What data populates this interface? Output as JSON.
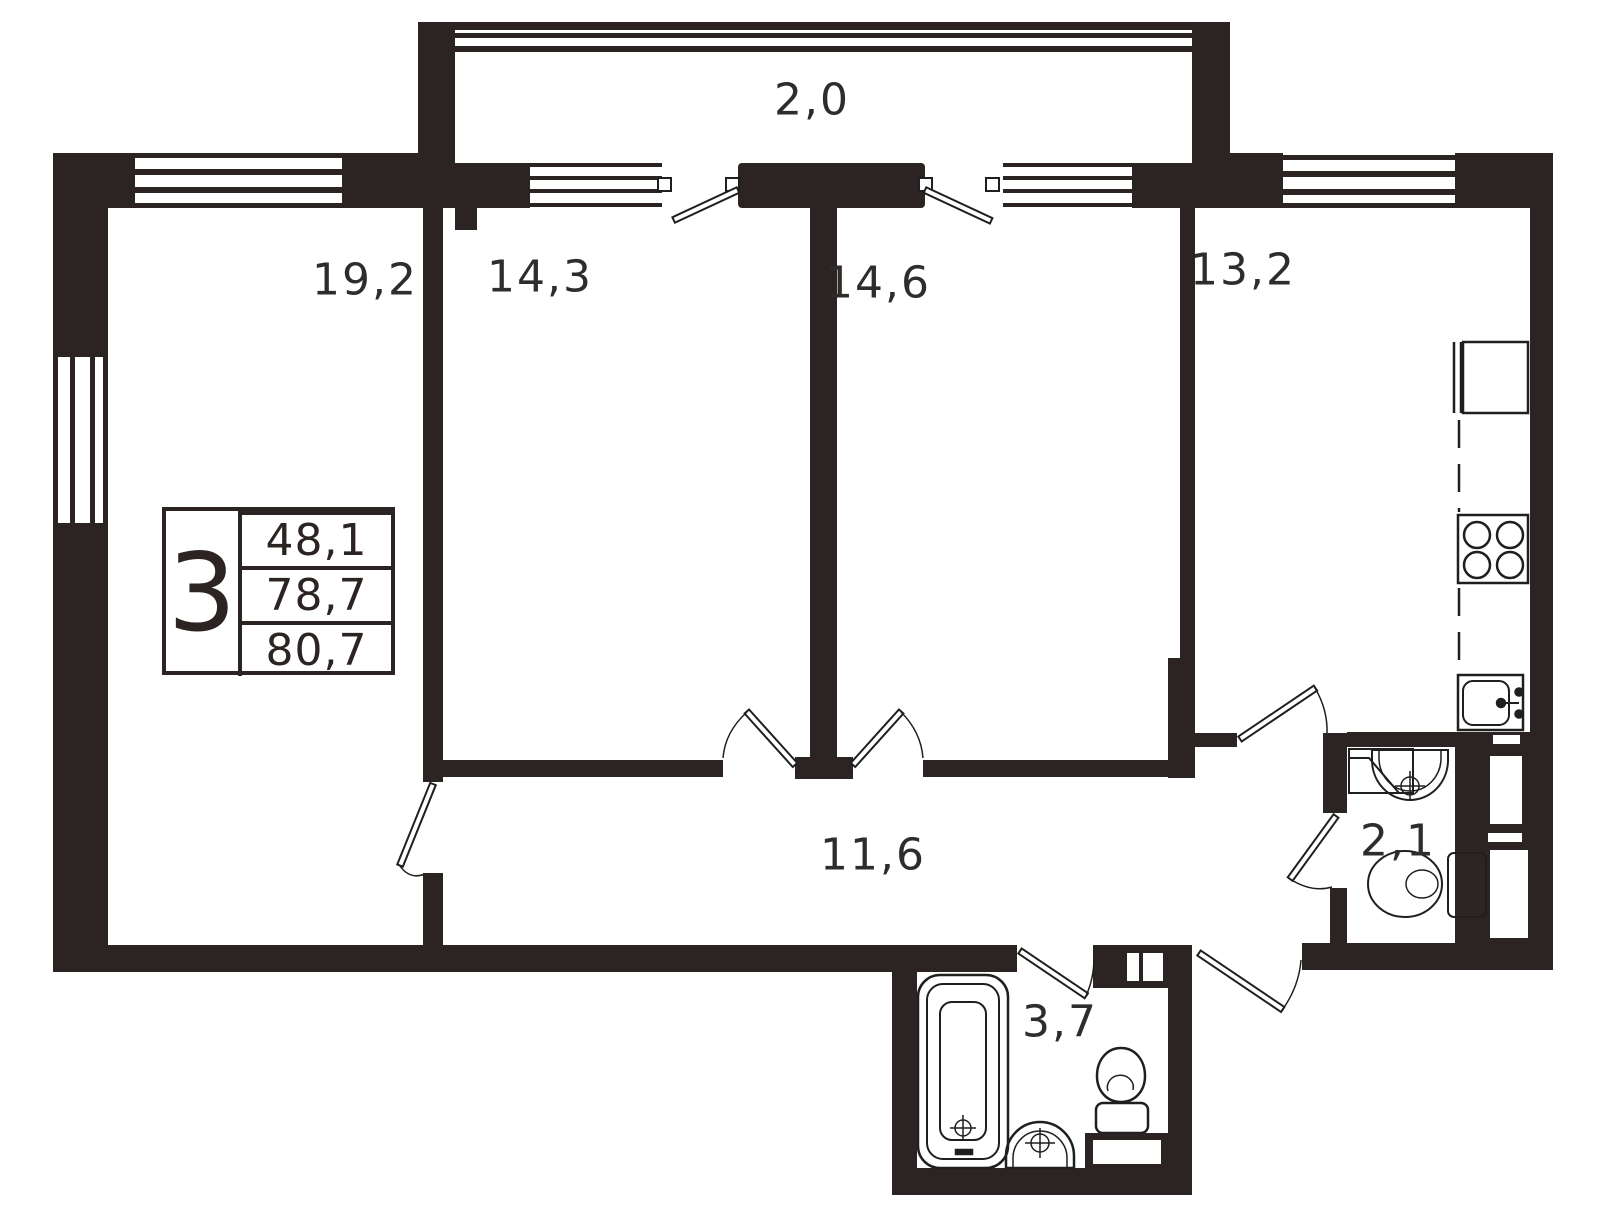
{
  "plan": {
    "title": "3-room apartment floor plan",
    "rooms": {
      "balcony": {
        "name": "balcony",
        "label": "2,0"
      },
      "living_room": {
        "name": "living room",
        "label": "19,2"
      },
      "bedroom_1": {
        "name": "bedroom 1",
        "label": "14,3"
      },
      "bedroom_2": {
        "name": "bedroom 2",
        "label": "14,6"
      },
      "kitchen": {
        "name": "kitchen",
        "label": "13,2"
      },
      "hallway": {
        "name": "hallway",
        "label": "11,6"
      },
      "wc": {
        "name": "toilet",
        "label": "2,1"
      },
      "bathroom": {
        "name": "bathroom",
        "label": "3,7"
      }
    },
    "info_table": {
      "room_count": "3",
      "values": [
        "48,1",
        "78,7",
        "80,7"
      ]
    },
    "colors": {
      "wall": "#2b2422",
      "line": "#1f1f1f",
      "text": "#2f2d2b",
      "background": "#ffffff"
    }
  }
}
